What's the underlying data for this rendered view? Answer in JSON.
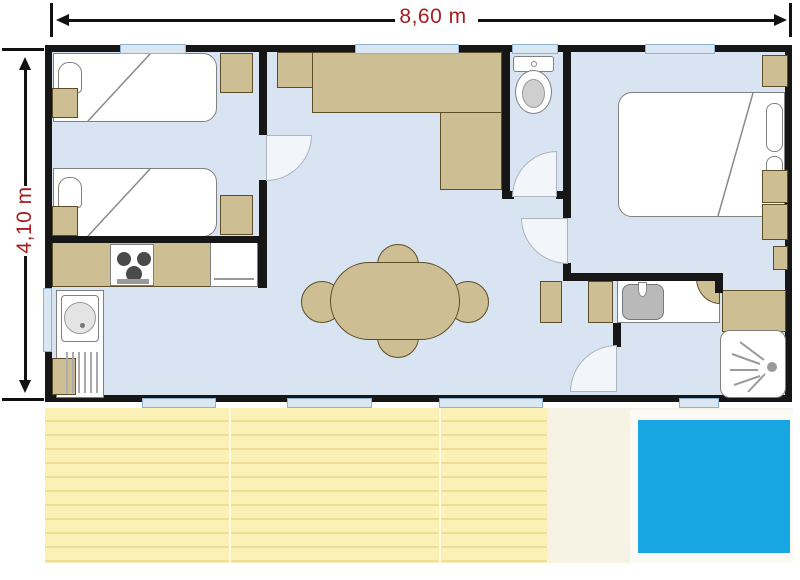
{
  "title": "mobile-home-floor-plan",
  "dimensions": {
    "width_label": "8,60 m",
    "height_label": "4,10 m"
  },
  "colors": {
    "floor": "#D9E4F2",
    "wall": "#161616",
    "tan": "#CDBE93",
    "tanb": "#5D4C28",
    "winb": "#8FB3CE",
    "winf": "#D9E7F3",
    "deck": "#FBF1B6",
    "deckline": "#EDDF95",
    "pool": "#18A7E2",
    "dim": "#A81C20",
    "fix": "#FFFFFF",
    "fixb": "#808080"
  },
  "plan": {
    "rooms": [
      "twin-bedroom",
      "living-dining",
      "kitchen",
      "wc",
      "hallway",
      "master-bedroom",
      "shower-room",
      "terrace-deck"
    ],
    "fixtures": [
      "single-bed",
      "single-bed",
      "hob",
      "kitchen-sink-drainer",
      "worktop-fridge",
      "corner-sofa",
      "dining-table-4-chairs",
      "toilet",
      "double-bed",
      "wardrobe",
      "washbasin",
      "corner-shower",
      "deck-boards",
      "paddling-pool"
    ]
  }
}
